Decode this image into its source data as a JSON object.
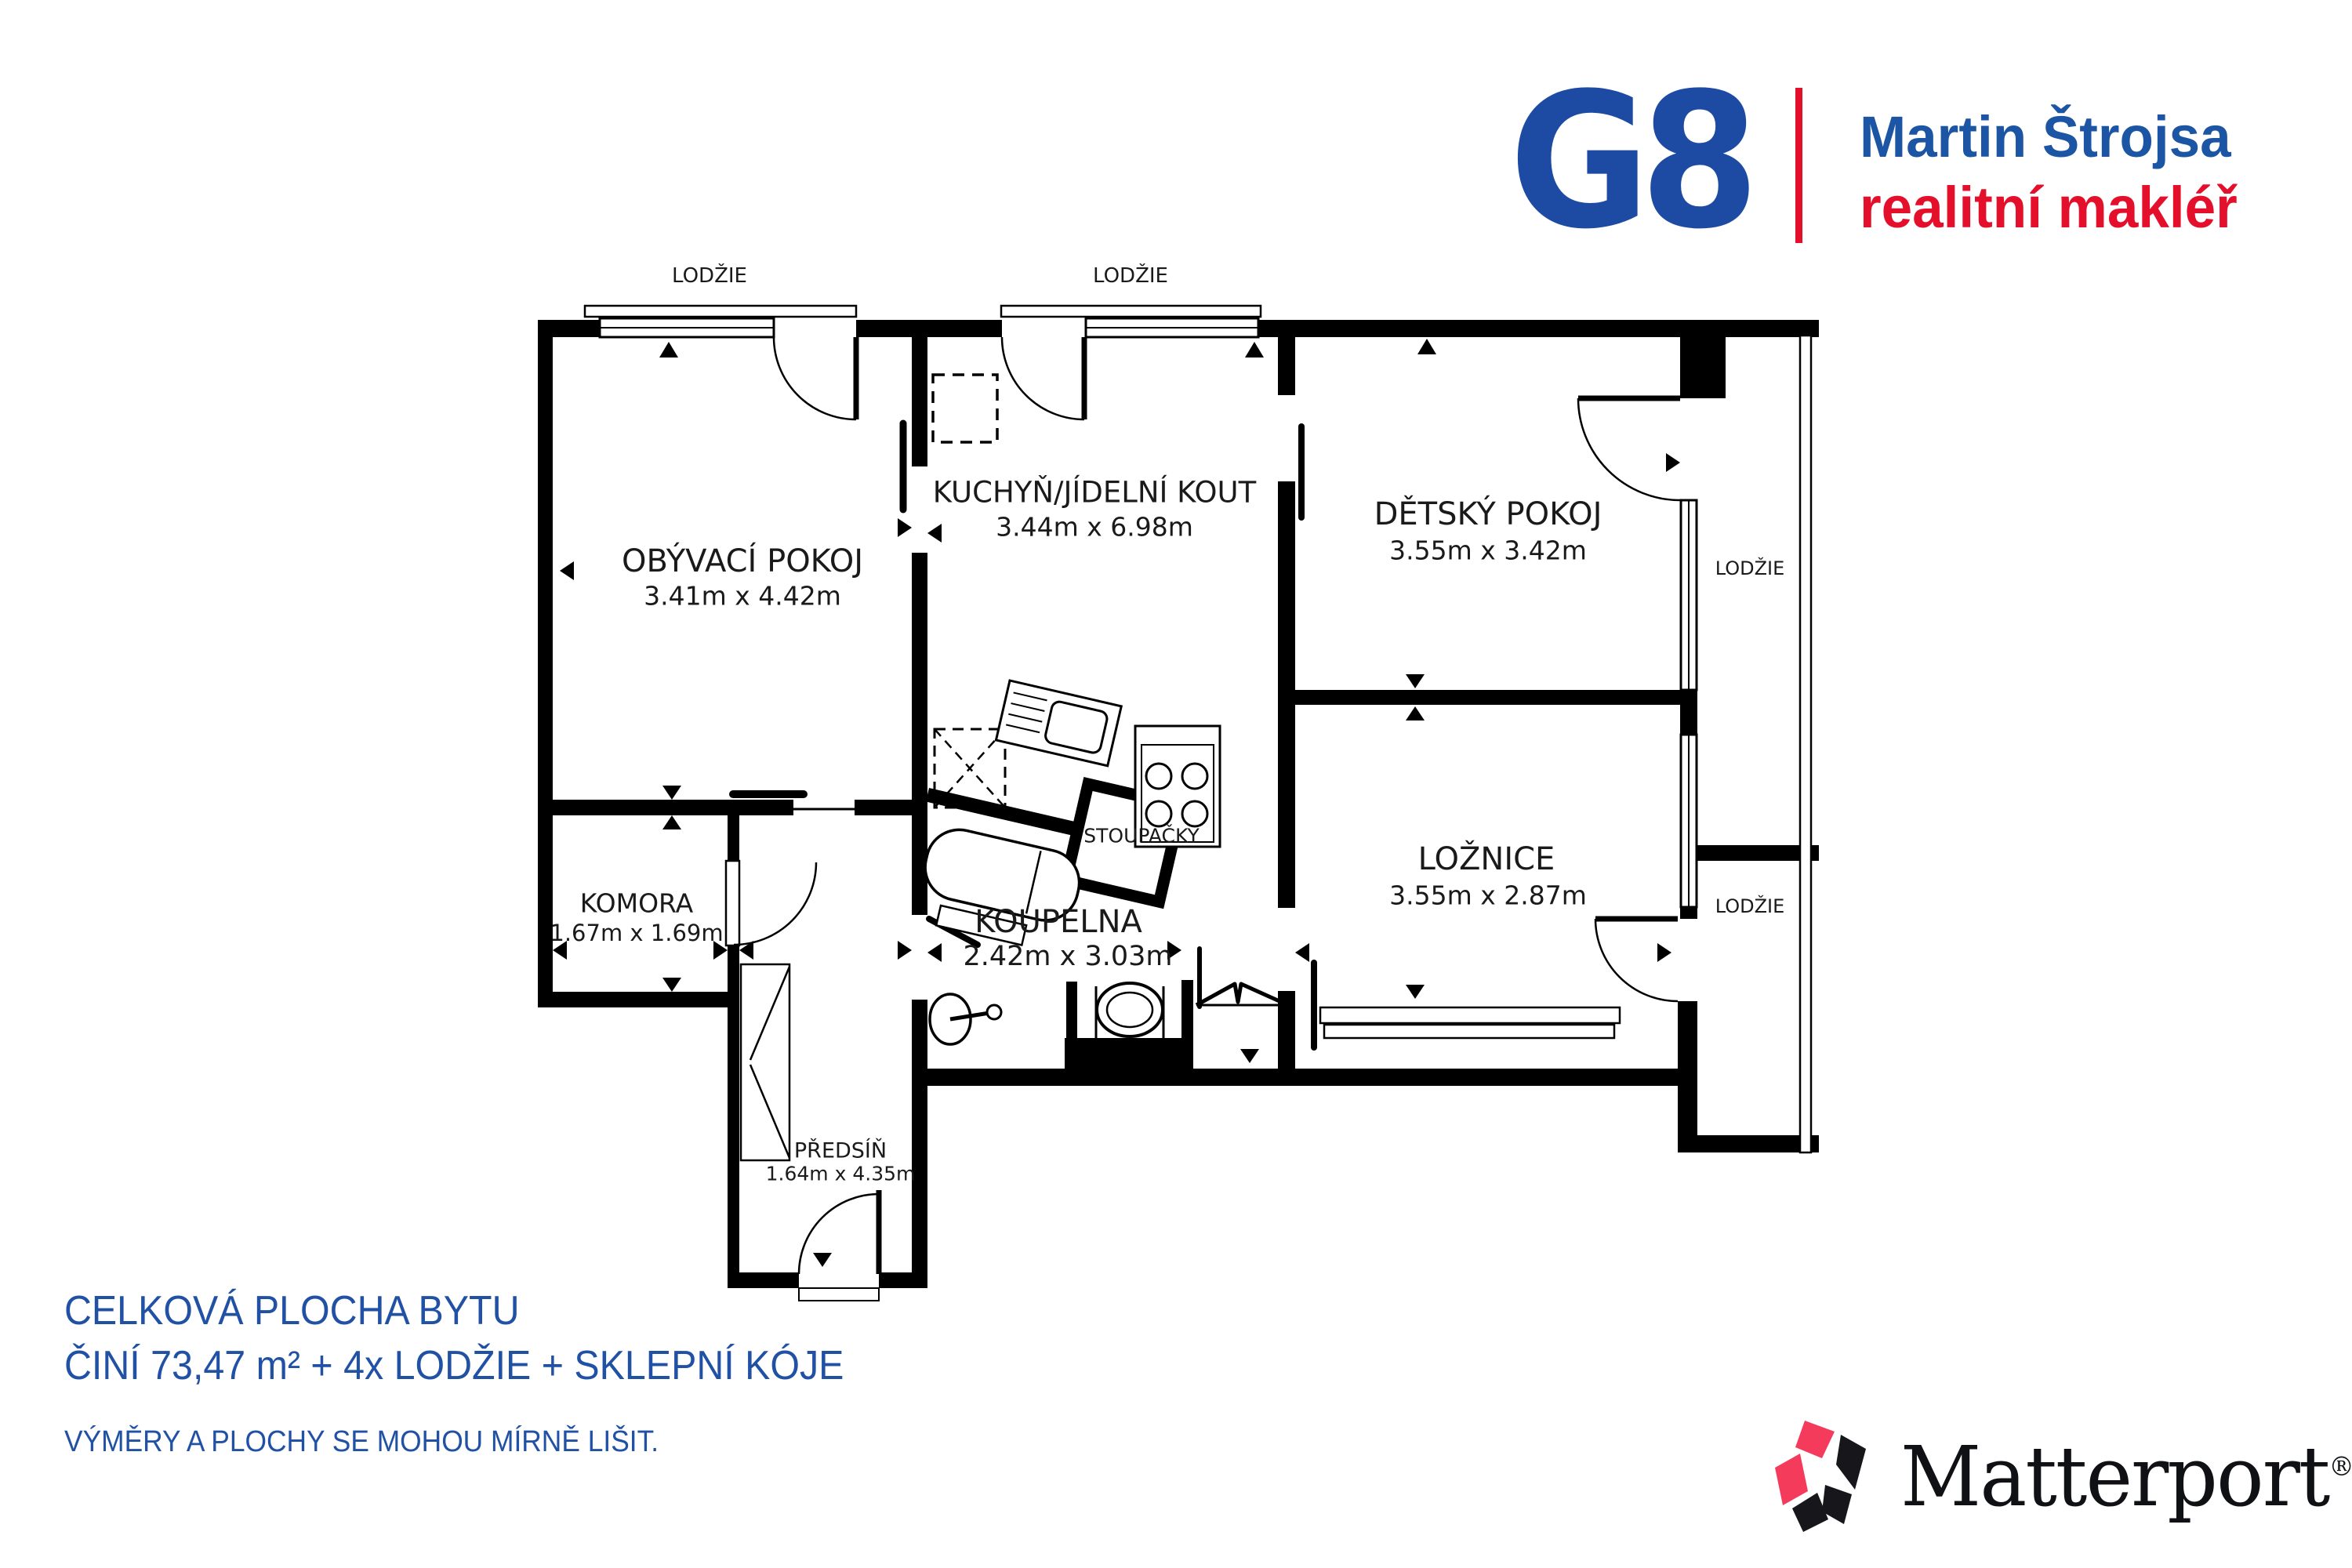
{
  "header": {
    "logo_text": "G8",
    "agent_name": "Martin Štrojsa",
    "agent_role": "realitní makléř",
    "logo_color": "#1d4ba4",
    "name_color": "#1c55a4",
    "role_color": "#e30f2b"
  },
  "floor_plan": {
    "balcony_labels": [
      "LODŽIE",
      "LODŽIE",
      "LODŽIE",
      "LODŽIE"
    ],
    "rooms": [
      {
        "name": "OBÝVACÍ POKOJ",
        "dims": "3.41m x 4.42m"
      },
      {
        "name": "KUCHYŇ/JÍDELNÍ KOUT",
        "dims": "3.44m x 6.98m"
      },
      {
        "name": "DĚTSKÝ POKOJ",
        "dims": "3.55m x 3.42m"
      },
      {
        "name": "LOŽNICE",
        "dims": "3.55m x 2.87m"
      },
      {
        "name": "KOMORA",
        "dims": "1.67m x 1.69m"
      },
      {
        "name": "KOUPELNA",
        "dims": "2.42m x 3.03m"
      },
      {
        "name": "PŘEDSÍŇ",
        "dims": "1.64m x 4.35m"
      }
    ],
    "shaft_label": "STOUPAČKY",
    "wall_color": "#000000"
  },
  "summary": {
    "line1": "CELKOVÁ PLOCHA BYTU",
    "line2": "ČINÍ 73,47 m² + 4x LODŽIE + SKLEPNÍ KÓJE",
    "disclaimer": "VÝMĚRY A PLOCHY SE MOHOU MÍRNĚ LIŠIT.",
    "text_color": "#2051a5"
  },
  "footer": {
    "brand": "Matterport",
    "registered_mark": "®",
    "accent_color": "#f43b5c"
  }
}
